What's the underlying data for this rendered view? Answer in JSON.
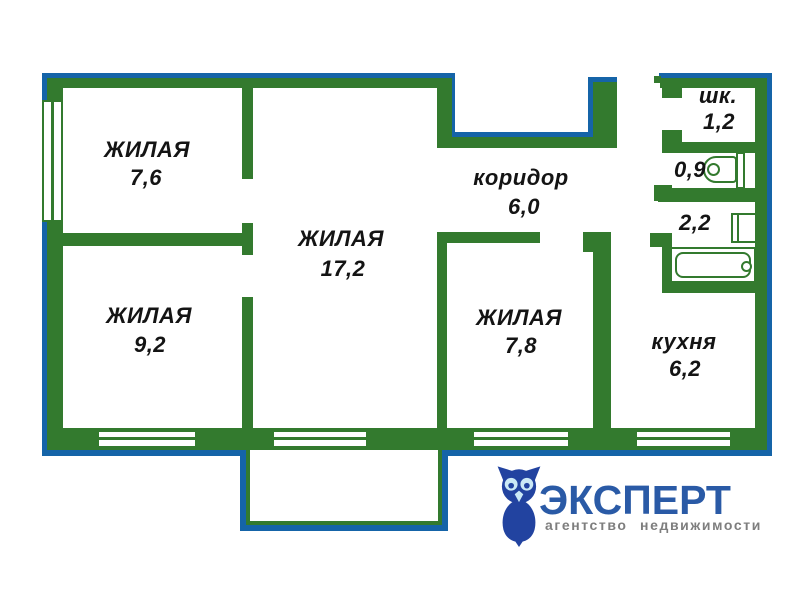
{
  "rooms": {
    "living1": {
      "name": "ЖИЛАЯ",
      "area": "7,6"
    },
    "living2": {
      "name": "ЖИЛАЯ",
      "area": "17,2"
    },
    "living3": {
      "name": "ЖИЛАЯ",
      "area": "9,2"
    },
    "living4": {
      "name": "ЖИЛАЯ",
      "area": "7,8"
    },
    "corridor": {
      "name": "коридор",
      "area": "6,0"
    },
    "kitchen": {
      "name": "кухня",
      "area": "6,2"
    },
    "closet": {
      "name": "шк.",
      "area": "1,2"
    },
    "wc": {
      "area": "0,9"
    },
    "bath": {
      "area": "2,2"
    }
  },
  "logo": {
    "brand": "ЭКСПЕРТ",
    "tagline": "агентство недвижимости"
  },
  "colors": {
    "wall": "#337A2E",
    "outline": "#1564A8",
    "text": "#141414",
    "brand": "#2A5AA6",
    "tagline": "#7E7E7E",
    "owl": "#2243A0",
    "owl_eye": "#CBE9F6"
  }
}
